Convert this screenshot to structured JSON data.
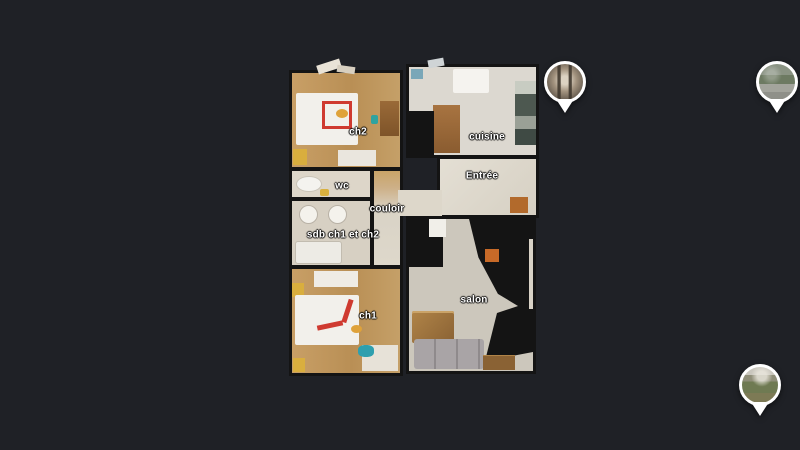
{
  "app": {
    "view": "3d-floorplan-top-view",
    "background_color": "#1f2126"
  },
  "floorplan": {
    "rooms": [
      {
        "id": "ch2",
        "label": "ch2"
      },
      {
        "id": "wc",
        "label": "wc"
      },
      {
        "id": "couloir",
        "label": "couloir"
      },
      {
        "id": "sdb",
        "label": "sdb ch1 et ch2"
      },
      {
        "id": "ch1",
        "label": "ch1"
      },
      {
        "id": "cuisine",
        "label": "cuisine"
      },
      {
        "id": "entree",
        "label": "Entrée"
      },
      {
        "id": "salon",
        "label": "salon"
      }
    ]
  },
  "markers": [
    {
      "id": "marker-1",
      "thumbnail": "interior-doorway-photo"
    },
    {
      "id": "marker-2",
      "thumbnail": "street-view-photo"
    },
    {
      "id": "marker-3",
      "thumbnail": "garden-view-photo"
    }
  ],
  "colors": {
    "background": "#1f2126",
    "wall": "#141414",
    "wood_floor": "#c89f66",
    "light_floor": "#ddd7ca",
    "label_text": "#ffffff",
    "pin": "#ffffff"
  }
}
